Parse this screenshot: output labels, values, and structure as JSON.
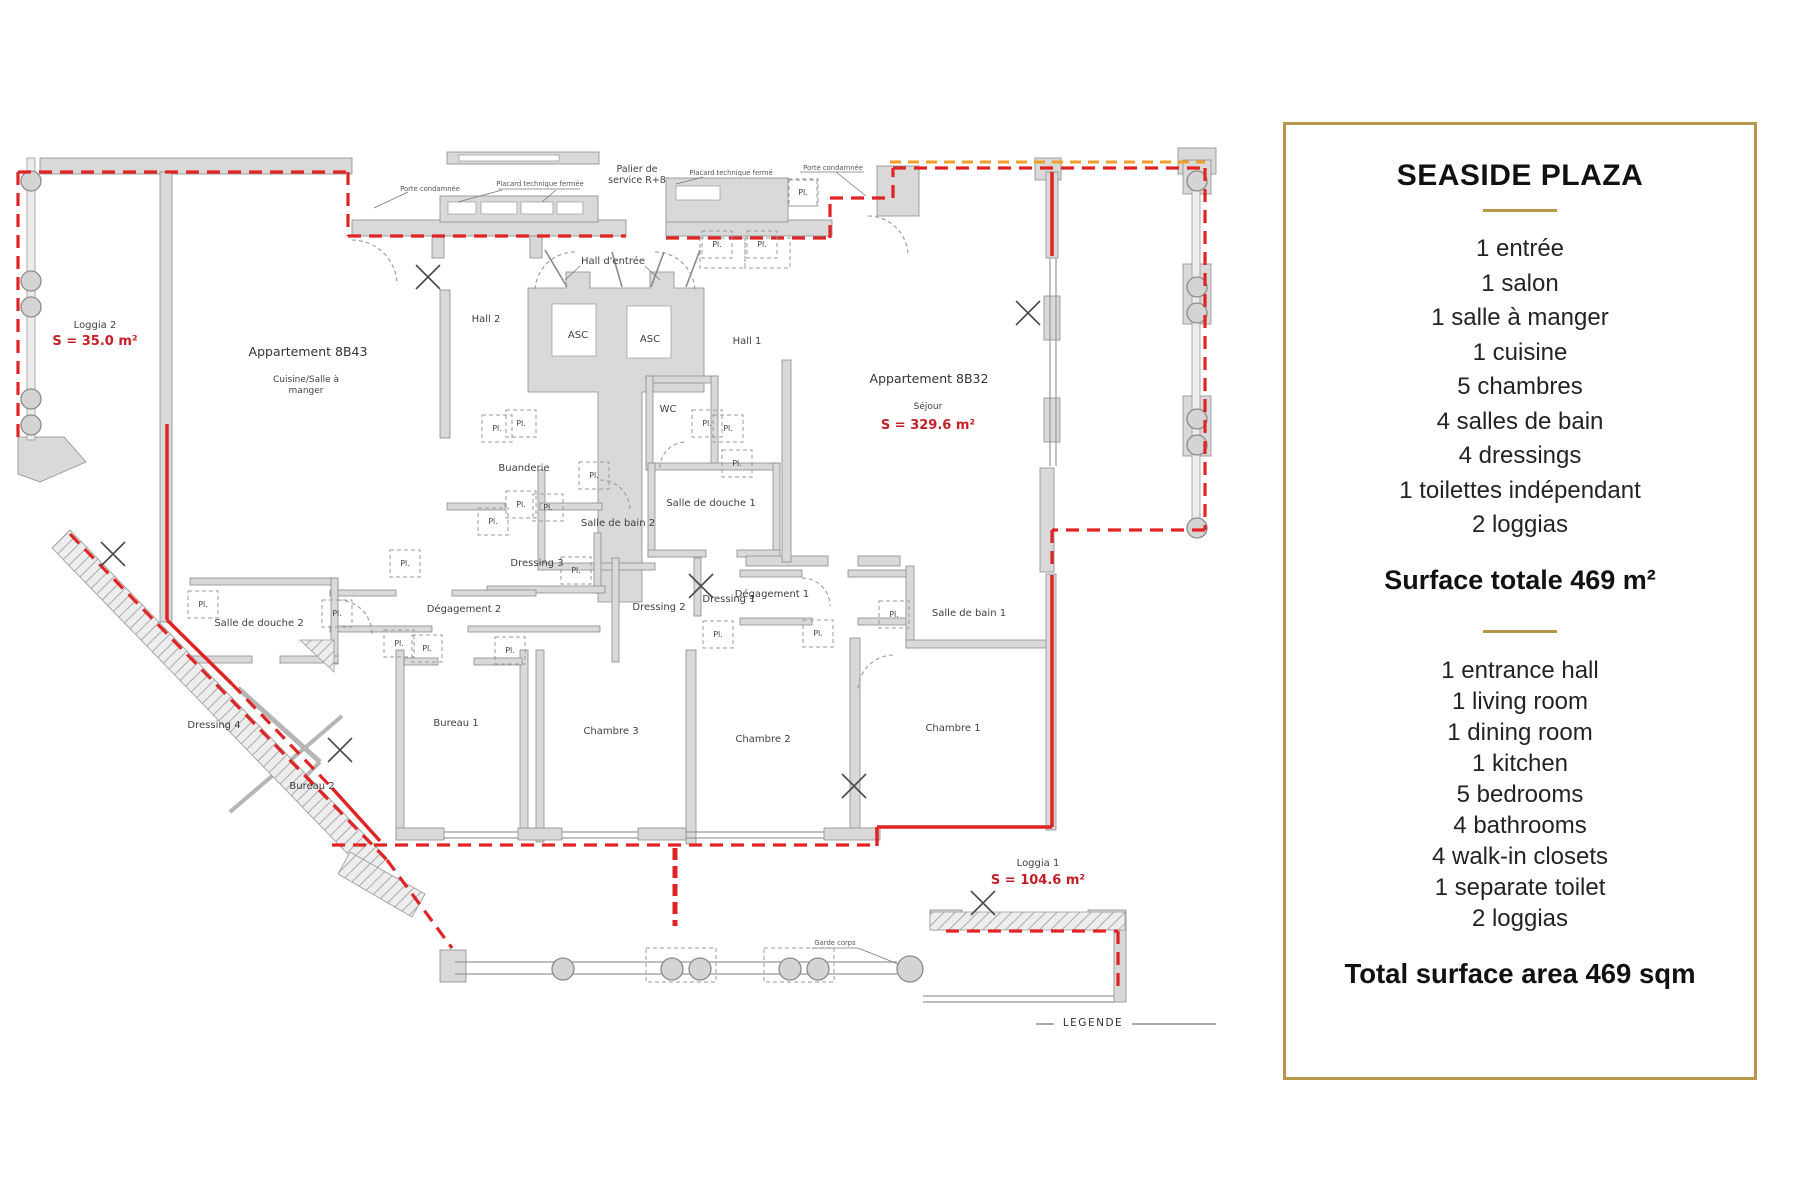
{
  "panel": {
    "title": "SEASIDE PLAZA",
    "accent_color": "#b5964a",
    "list_fr": [
      "1 entrée",
      "1 salon",
      "1 salle à manger",
      "1 cuisine",
      "5 chambres",
      "4 salles de bain",
      "4 dressings",
      "1 toilettes indépendant",
      "2 loggias"
    ],
    "subtotal_fr": "Surface totale 469 m²",
    "list_en": [
      "1 entrance hall",
      "1 living room",
      "1 dining room",
      "1 kitchen",
      "5 bedrooms",
      "4 bathrooms",
      "4 walk-in closets",
      "1 separate toilet",
      "2 loggias"
    ],
    "subtotal_en": "Total surface area 469 sqm"
  },
  "plan": {
    "colors": {
      "wall": "#d9d9d9",
      "wall_stroke": "#8a8a8a",
      "boundary_red": "#e02424",
      "boundary_orange": "#f59d27",
      "area_red": "#c41f26"
    },
    "apartments": [
      {
        "name": "Appartement 8B43",
        "x": 308,
        "y": 356,
        "sub_lines": [
          "Cuisine/Salle à",
          "manger"
        ],
        "sub_x": 306,
        "sub_y": 382
      },
      {
        "name": "Appartement 8B32",
        "x": 929,
        "y": 383,
        "sub_lines": [
          "Séjour"
        ],
        "sub_x": 928,
        "sub_y": 409
      }
    ],
    "areas": [
      {
        "label": "S = 35.0 m²",
        "x": 95,
        "y": 345
      },
      {
        "label": "S = 329.6 m²",
        "x": 928,
        "y": 429
      },
      {
        "label": "S = 104.6 m²",
        "x": 1038,
        "y": 884
      }
    ],
    "rooms": [
      {
        "label": "Loggia 2",
        "x": 95,
        "y": 328
      },
      {
        "label": "Hall 2",
        "x": 486,
        "y": 322
      },
      {
        "label": "Hall d'entrée",
        "x": 613,
        "y": 264
      },
      {
        "label": "Hall 1",
        "x": 747,
        "y": 344
      },
      {
        "label": "ASC",
        "x": 578,
        "y": 338
      },
      {
        "label": "ASC",
        "x": 650,
        "y": 342
      },
      {
        "label": "WC",
        "x": 668,
        "y": 412
      },
      {
        "label": "Buanderie",
        "x": 524,
        "y": 471
      },
      {
        "label": "Salle de bain 2",
        "x": 618,
        "y": 526
      },
      {
        "label": "Salle de douche 1",
        "x": 711,
        "y": 506
      },
      {
        "label": "Dressing 3",
        "x": 537,
        "y": 566
      },
      {
        "label": "Dégagement 2",
        "x": 464,
        "y": 612
      },
      {
        "label": "Dressing 2",
        "x": 659,
        "y": 610
      },
      {
        "label": "Dressing 1",
        "x": 729,
        "y": 602
      },
      {
        "label": "Dégagement 1",
        "x": 772,
        "y": 597
      },
      {
        "label": "Salle de douche 2",
        "x": 259,
        "y": 626
      },
      {
        "label": "Dressing 4",
        "x": 214,
        "y": 728
      },
      {
        "label": "Bureau 2",
        "x": 312,
        "y": 789
      },
      {
        "label": "Bureau 1",
        "x": 456,
        "y": 726
      },
      {
        "label": "Chambre 3",
        "x": 611,
        "y": 734
      },
      {
        "label": "Chambre 2",
        "x": 763,
        "y": 742
      },
      {
        "label": "Chambre 1",
        "x": 953,
        "y": 731
      },
      {
        "label": "Salle de bain 1",
        "x": 969,
        "y": 616
      },
      {
        "label": "Loggia 1",
        "x": 1038,
        "y": 866
      }
    ],
    "service_label": {
      "lines": [
        "Palier de",
        "service R+8"
      ],
      "x": 637,
      "y": 172
    },
    "tiny_labels": [
      {
        "label": "Porte condamnée",
        "x": 430,
        "y": 191
      },
      {
        "label": "Placard technique fermée",
        "x": 540,
        "y": 186
      },
      {
        "label": "Placard technique fermé",
        "x": 731,
        "y": 175
      },
      {
        "label": "Porte condamnée",
        "x": 833,
        "y": 170
      },
      {
        "label": "Garde corps",
        "x": 835,
        "y": 945
      }
    ],
    "pl_text": "Pl.",
    "pl_positions": [
      [
        717,
        245
      ],
      [
        762,
        245
      ],
      [
        803,
        193
      ],
      [
        497,
        429
      ],
      [
        521,
        424
      ],
      [
        707,
        424
      ],
      [
        728,
        429
      ],
      [
        737,
        464
      ],
      [
        594,
        476
      ],
      [
        521,
        505
      ],
      [
        548,
        508
      ],
      [
        493,
        522
      ],
      [
        405,
        564
      ],
      [
        576,
        571
      ],
      [
        337,
        614
      ],
      [
        203,
        605
      ],
      [
        399,
        644
      ],
      [
        427,
        649
      ],
      [
        510,
        651
      ],
      [
        718,
        635
      ],
      [
        818,
        634
      ],
      [
        894,
        615
      ]
    ],
    "legend": {
      "label": "LEGENDE",
      "x": 1093,
      "y": 1026
    }
  }
}
